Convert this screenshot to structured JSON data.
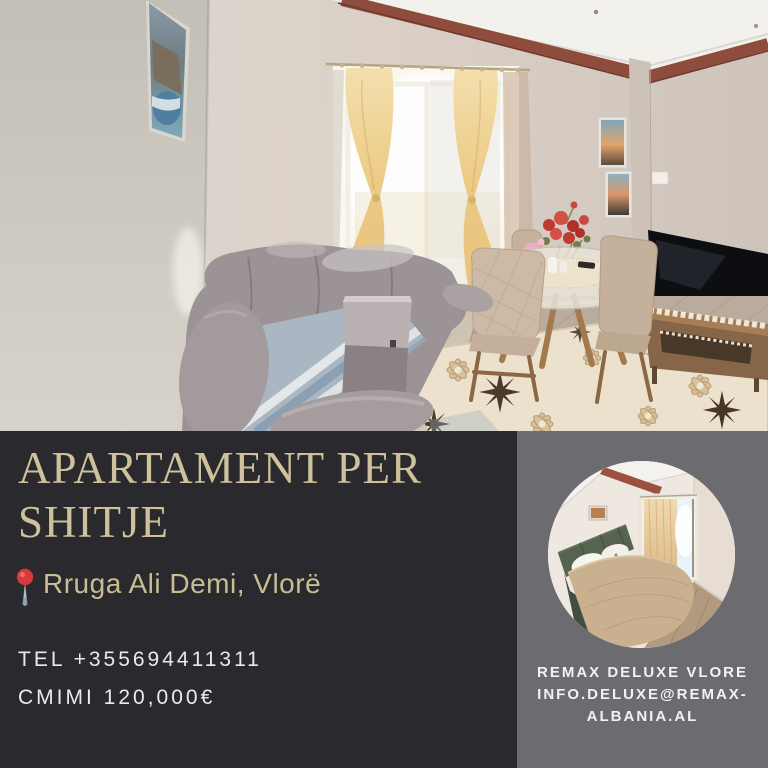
{
  "poster": {
    "headline": "APARTAMENT PER SHITJE",
    "location": "Rruga Ali Demi, Vlorë",
    "phone": "TEL +355694411311",
    "price": "CMIMI 120,000€",
    "agency": {
      "name": "REMAX DELUXE VLORE",
      "email": "INFO.DELUXE@REMAX-ALBANIA.AL"
    },
    "photos": {
      "living_room_alt": "Living room with grey corner sofa, gold tied curtains on a bright balcony window, round glass dining table with beige chairs, red flowers, TV on wooden stand and cream floral rug",
      "bedroom_alt": "Bedroom with green upholstered bed, beige bedspread, white pillows and curtained bright window"
    },
    "colors": {
      "panel_dark": "#2a292e",
      "panel_gray": "#6c6b70",
      "accent_gold": "#cfc19b",
      "location_gold": "#c9bd94",
      "text_light": "#e9eaeb",
      "pin_red": "#d8393c"
    }
  }
}
